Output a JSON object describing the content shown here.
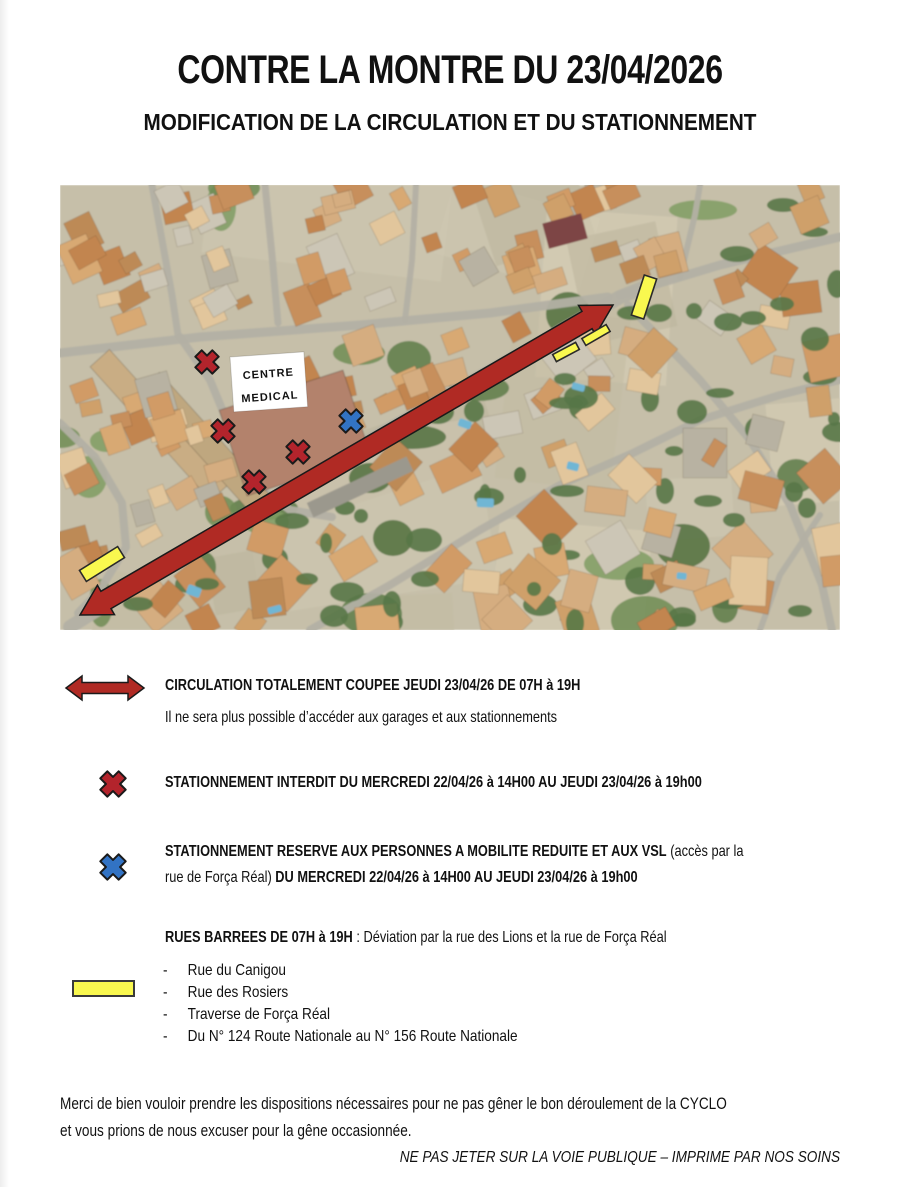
{
  "header": {
    "title": "CONTRE LA MONTRE DU 23/04/2026",
    "subtitle": "MODIFICATION DE LA CIRCULATION ET DU STATIONNEMENT"
  },
  "map": {
    "label_line1": "CENTRE",
    "label_line2": "MEDICAL",
    "arrow": {
      "x1": 20,
      "y1": 430,
      "x2": 553,
      "y2": 120
    },
    "red_x": [
      [
        147,
        177
      ],
      [
        163,
        246
      ],
      [
        238,
        267
      ],
      [
        194,
        297
      ]
    ],
    "blue_x": [
      [
        291,
        236
      ]
    ],
    "yellow_bars": [
      {
        "cx": 42,
        "cy": 379,
        "w": 45,
        "h": 13,
        "rot": -32
      },
      {
        "cx": 584,
        "cy": 112,
        "w": 13,
        "h": 42,
        "rot": 18
      },
      {
        "cx": 536,
        "cy": 150,
        "w": 28,
        "h": 8,
        "rot": -30
      },
      {
        "cx": 506,
        "cy": 167,
        "w": 26,
        "h": 8,
        "rot": -28
      }
    ],
    "colors": {
      "arrow": "#b02a24",
      "red_x": "#b3242c",
      "blue_x": "#3273c4",
      "yellow": "#f9f84f"
    }
  },
  "legend": {
    "circulation": {
      "heading": "CIRCULATION TOTALEMENT COUPEE JEUDI 23/04/26 DE 07H à 19H",
      "note": "Il ne sera plus possible d’accéder aux garages et aux stationnements"
    },
    "interdit": {
      "heading": "STATIONNEMENT INTERDIT DU MERCREDI 22/04/26 à 14H00 AU JEUDI 23/04/26 à 19h00"
    },
    "reserve": {
      "line1_bold": "STATIONNEMENT RESERVE AUX PERSONNES A MOBILITE REDUITE ET AUX VSL",
      "line1_normal": "(accès par la",
      "line2_normal": "rue de Força Réal)",
      "line2_bold": "DU MERCREDI 22/04/26 à 14H00 AU JEUDI 23/04/26 à 19h00"
    },
    "rues": {
      "heading_bold": "RUES BARREES DE 07H à 19H",
      "heading_normal": " : Déviation par la rue des Lions et la rue de Força Réal",
      "streets": [
        "Rue du Canigou",
        "Rue des Rosiers",
        "Traverse de Força Réal",
        "Du N° 124 Route Nationale au N° 156 Route Nationale"
      ]
    }
  },
  "footer": {
    "line1": "Merci de bien vouloir prendre les dispositions nécessaires pour ne pas gêner le bon déroulement de la CYCLO",
    "line2": "et vous prions de nous excuser pour la gêne occasionnée.",
    "disclaimer": "NE PAS JETER SUR LA VOIE PUBLIQUE – IMPRIME PAR NOS SOINS"
  }
}
